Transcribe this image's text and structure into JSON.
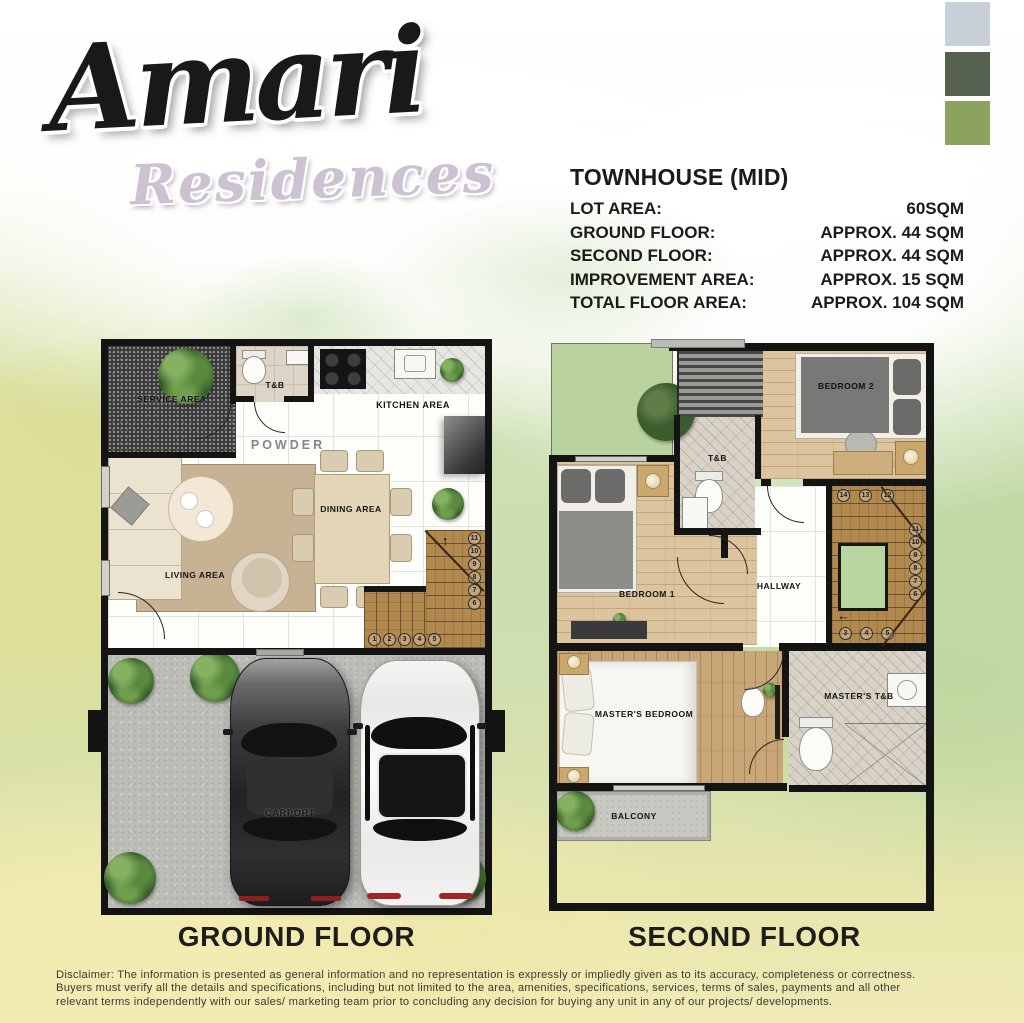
{
  "logo": {
    "title": "Amari",
    "subtitle": "Residences"
  },
  "palette": {
    "swatch_1": "#c7cfd9",
    "swatch_2": "#57614f",
    "swatch_3": "#8ba261"
  },
  "specs": {
    "title": "TOWNHOUSE (MID)",
    "rows": [
      {
        "label": "LOT AREA:",
        "value": "60SQM"
      },
      {
        "label": "GROUND FLOOR:",
        "value": "APPROX. 44 SQM"
      },
      {
        "label": "SECOND FLOOR:",
        "value": "APPROX. 44 SQM"
      },
      {
        "label": "IMPROVEMENT AREA:",
        "value": "APPROX. 15 SQM"
      },
      {
        "label": "TOTAL FLOOR AREA:",
        "value": "APPROX. 104 SQM"
      }
    ]
  },
  "ground_floor": {
    "caption": "GROUND FLOOR",
    "rooms": {
      "service_area": "SERVICE AREA",
      "tb": "T&B",
      "kitchen": "KITCHEN AREA",
      "powder": "POWDER",
      "dining": "DINING AREA",
      "living": "LIVING AREA",
      "carport": "CARPORT"
    },
    "stairs": {
      "run_low": [
        "1",
        "2",
        "3",
        "4",
        "5"
      ],
      "run_high": [
        "11",
        "10",
        "9",
        "8",
        "7",
        "6"
      ]
    }
  },
  "second_floor": {
    "caption": "SECOND FLOOR",
    "rooms": {
      "bedroom2": "BEDROOM 2",
      "tb": "T&B",
      "bedroom1": "BEDROOM 1",
      "hallway": "HALLWAY",
      "masters_bedroom": "MASTER'S BEDROOM",
      "masters_tb": "MASTER'S T&B",
      "balcony": "BALCONY"
    },
    "stairs": {
      "top": [
        "14",
        "13",
        "12"
      ],
      "right": [
        "11",
        "10",
        "9",
        "8",
        "7",
        "6"
      ],
      "bottom": [
        "3",
        "4",
        "5"
      ]
    }
  },
  "icons": {
    "up_arrow": "↑",
    "left_arrow": "←"
  },
  "disclaimer": {
    "line1": "Disclaimer: The information is presented as general information and no representation is expressly or impliedly given as to its accuracy, completeness or correctness.",
    "line2": "Buyers must verify all the details and specifications, including but not limited to the area, amenities, specifications, services, terms of sales, payments and all other",
    "line3": "relevant terms independently with our sales/ marketing team prior to concluding any decision for buying any unit in any of our projects/ developments."
  }
}
